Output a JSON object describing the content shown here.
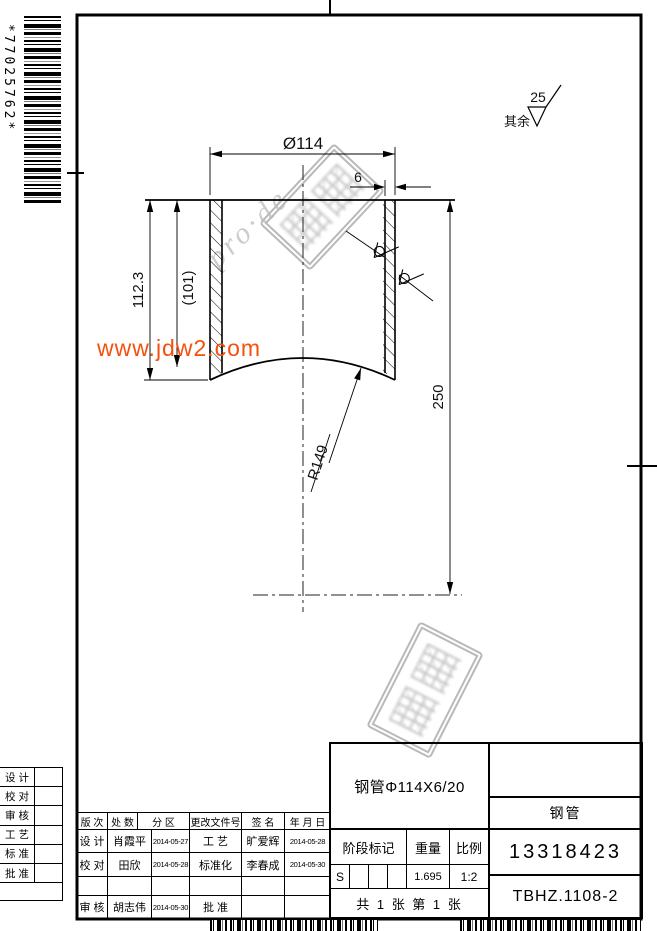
{
  "barcodes": {
    "left_code": "*77025762*"
  },
  "watermarks": {
    "site": "www.jdw2.com",
    "diagonal": "pro·de"
  },
  "surface_note": {
    "label": "其余",
    "roughness": "25"
  },
  "dims": {
    "diameter": "Ø114",
    "thickness": "6",
    "height": "112.3",
    "ref_height": "(101)",
    "length": "250",
    "radius": "R149"
  },
  "title_block": {
    "spec": "钢管Φ114X6/20",
    "part_name": "钢管",
    "drawing_no": "13318423",
    "doc_no": "TBHZ.1108-2",
    "stage_label": "阶段标记",
    "weight_label": "重量",
    "scale_label": "比例",
    "stage_value": "S",
    "weight_value": "1.695",
    "scale_value": "1:2",
    "sheet_info": "共 1 张  第 1 张"
  },
  "revision_table": {
    "headers": [
      "版 次",
      "处 数",
      "分  区",
      "更改文件号",
      "签 名",
      "年 月 日"
    ],
    "rows": [
      [
        "设 计",
        "肖霞平",
        "2014-05-27",
        "工 艺",
        "旷爱辉",
        "2014-05-28"
      ],
      [
        "校 对",
        "田欣",
        "2014-05-28",
        "标准化",
        "李春成",
        "2014-05-30"
      ],
      [
        "",
        "",
        "",
        "",
        "",
        ""
      ],
      [
        "审 核",
        "胡志伟",
        "2014-05-30",
        "批 准",
        "",
        ""
      ]
    ]
  },
  "margin_labels": [
    "设 计",
    "校 对",
    "审 核",
    "工 艺",
    "标 准",
    "批 准"
  ]
}
